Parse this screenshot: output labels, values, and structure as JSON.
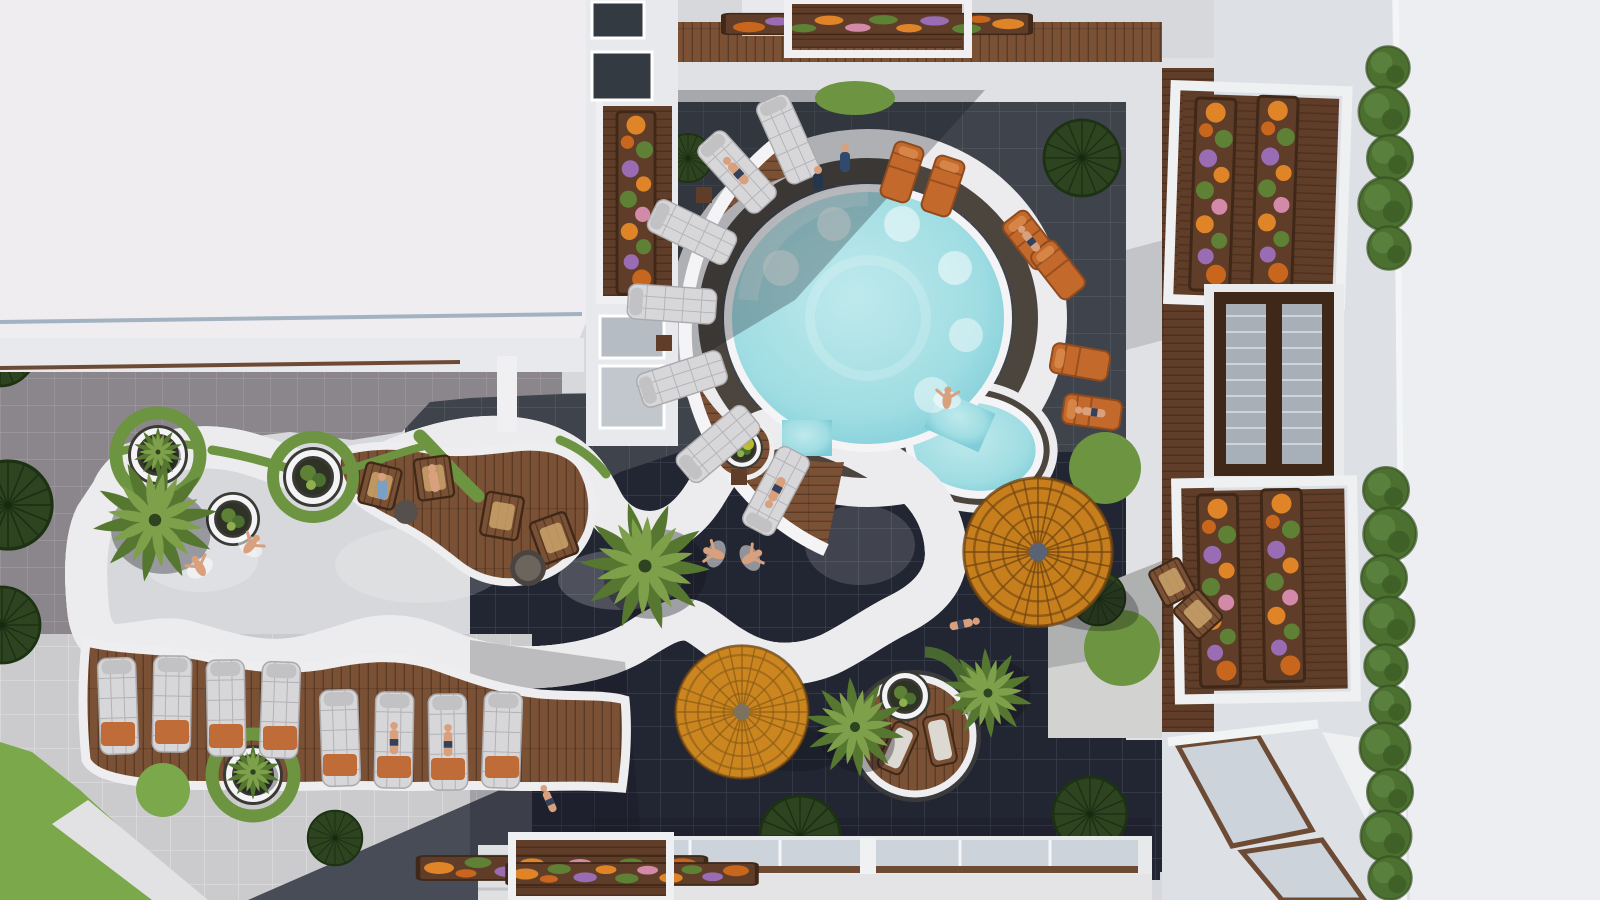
{
  "meta": {
    "type": "aerial architectural rendering",
    "description": "Top-down plan view of a modern resort courtyard: a freeform lazy-river pool with a circular basin winds between white apartment buildings, dark charcoal tile patios, timber decks with sun loungers, amber thatched umbrellas, palm trees and flower-filled balcony planters.",
    "time_of_day": "bright daylight with hard shadows"
  },
  "palette": {
    "roof_white": "#efedf0",
    "roof_bright": "#eceef2",
    "wall_white": "#e7e9ec",
    "facade": "#dde1e6",
    "concrete_light": "#d6d8db",
    "concrete_band": "#dfe1e4",
    "paver_gray": "#8b868c",
    "paver_gray_grout": "#9d989e",
    "paver_light": "#cbcbce",
    "paver_light_grout": "#dbdbdd",
    "tile_charcoal": "#3f434b",
    "tile_charcoal_grout": "#51565e",
    "tile_navy": "#222632",
    "tile_navy_grout": "#3a3f4c",
    "dkgray_wedge": "#484c56",
    "wood_deck": "#7b5136",
    "wood_dark": "#5f3d28",
    "wood_line": "#3f2817",
    "water_light": "#bfe9ec",
    "water_mid": "#9fdde3",
    "water_deep": "#7fccd8",
    "pool_rim": "#f4f4f6",
    "pool_halo": "#ececee",
    "pool_stone": "#4c453d",
    "umbrella_amber": "#c77f1d",
    "umbrella_gold": "#d89a26",
    "umbrella_line": "#6e4410",
    "grass": "#6d9440",
    "grass_bright": "#7aa84b",
    "hedge": "#4c7030",
    "tree_dark": "#2e4420",
    "palm_green": "#7fa04b",
    "palm_dark": "#55772f",
    "flower_orange": "#e08428",
    "flower_deep_orange": "#c9661d",
    "flower_purple": "#9a6cb4",
    "flower_pink": "#d389a8",
    "leaf_green": "#5e8136",
    "lounger_white": "#d7d7d9",
    "lounger_seam": "#aaaaae",
    "towel_orange": "#c06c38",
    "chair_orange": "#c4692c",
    "chair_orange_dark": "#8f4a1e",
    "glass": "#ccd3da",
    "glass_dark": "#a7b0b9",
    "frame_brown": "#6d4a33",
    "window_dark": "#343a42",
    "skin": "#d8a07c",
    "shadow": "#12141c",
    "splash": "#ffffff"
  },
  "scene": {
    "buildings": {
      "top_left_roof": "large flat white roof block",
      "right_wing": "white facade with projecting balconies, flower boxes and a hedge-lined roof edge",
      "bottom_edge": "glass walkway canopies with timber rails"
    },
    "pool": {
      "shape": "freeform lazy-river connected to a circular basin",
      "features": [
        "white wavy coping",
        "dark natural-stone edging",
        "in-pool circular planters",
        "underwater seating discs",
        "swim-up channel"
      ]
    },
    "furniture": {
      "white_quilted_loungers": 15,
      "orange_sun_loungers": 6,
      "timber_armchairs": 6,
      "timber_island_loungers": 2,
      "thatched_umbrellas": 2,
      "side_tables": 5
    },
    "vegetation": {
      "bright_palm_trees": 6,
      "dark_canopy_trees": 9,
      "hedge_bushes": 15,
      "round_planters": 6,
      "flower_boxes": 6,
      "flower_colors": [
        "orange",
        "purple",
        "pink",
        "green"
      ]
    },
    "people": {
      "swimmers": 5,
      "sunbathers_on_loungers": 6,
      "standing_or_sitting": 5
    }
  }
}
